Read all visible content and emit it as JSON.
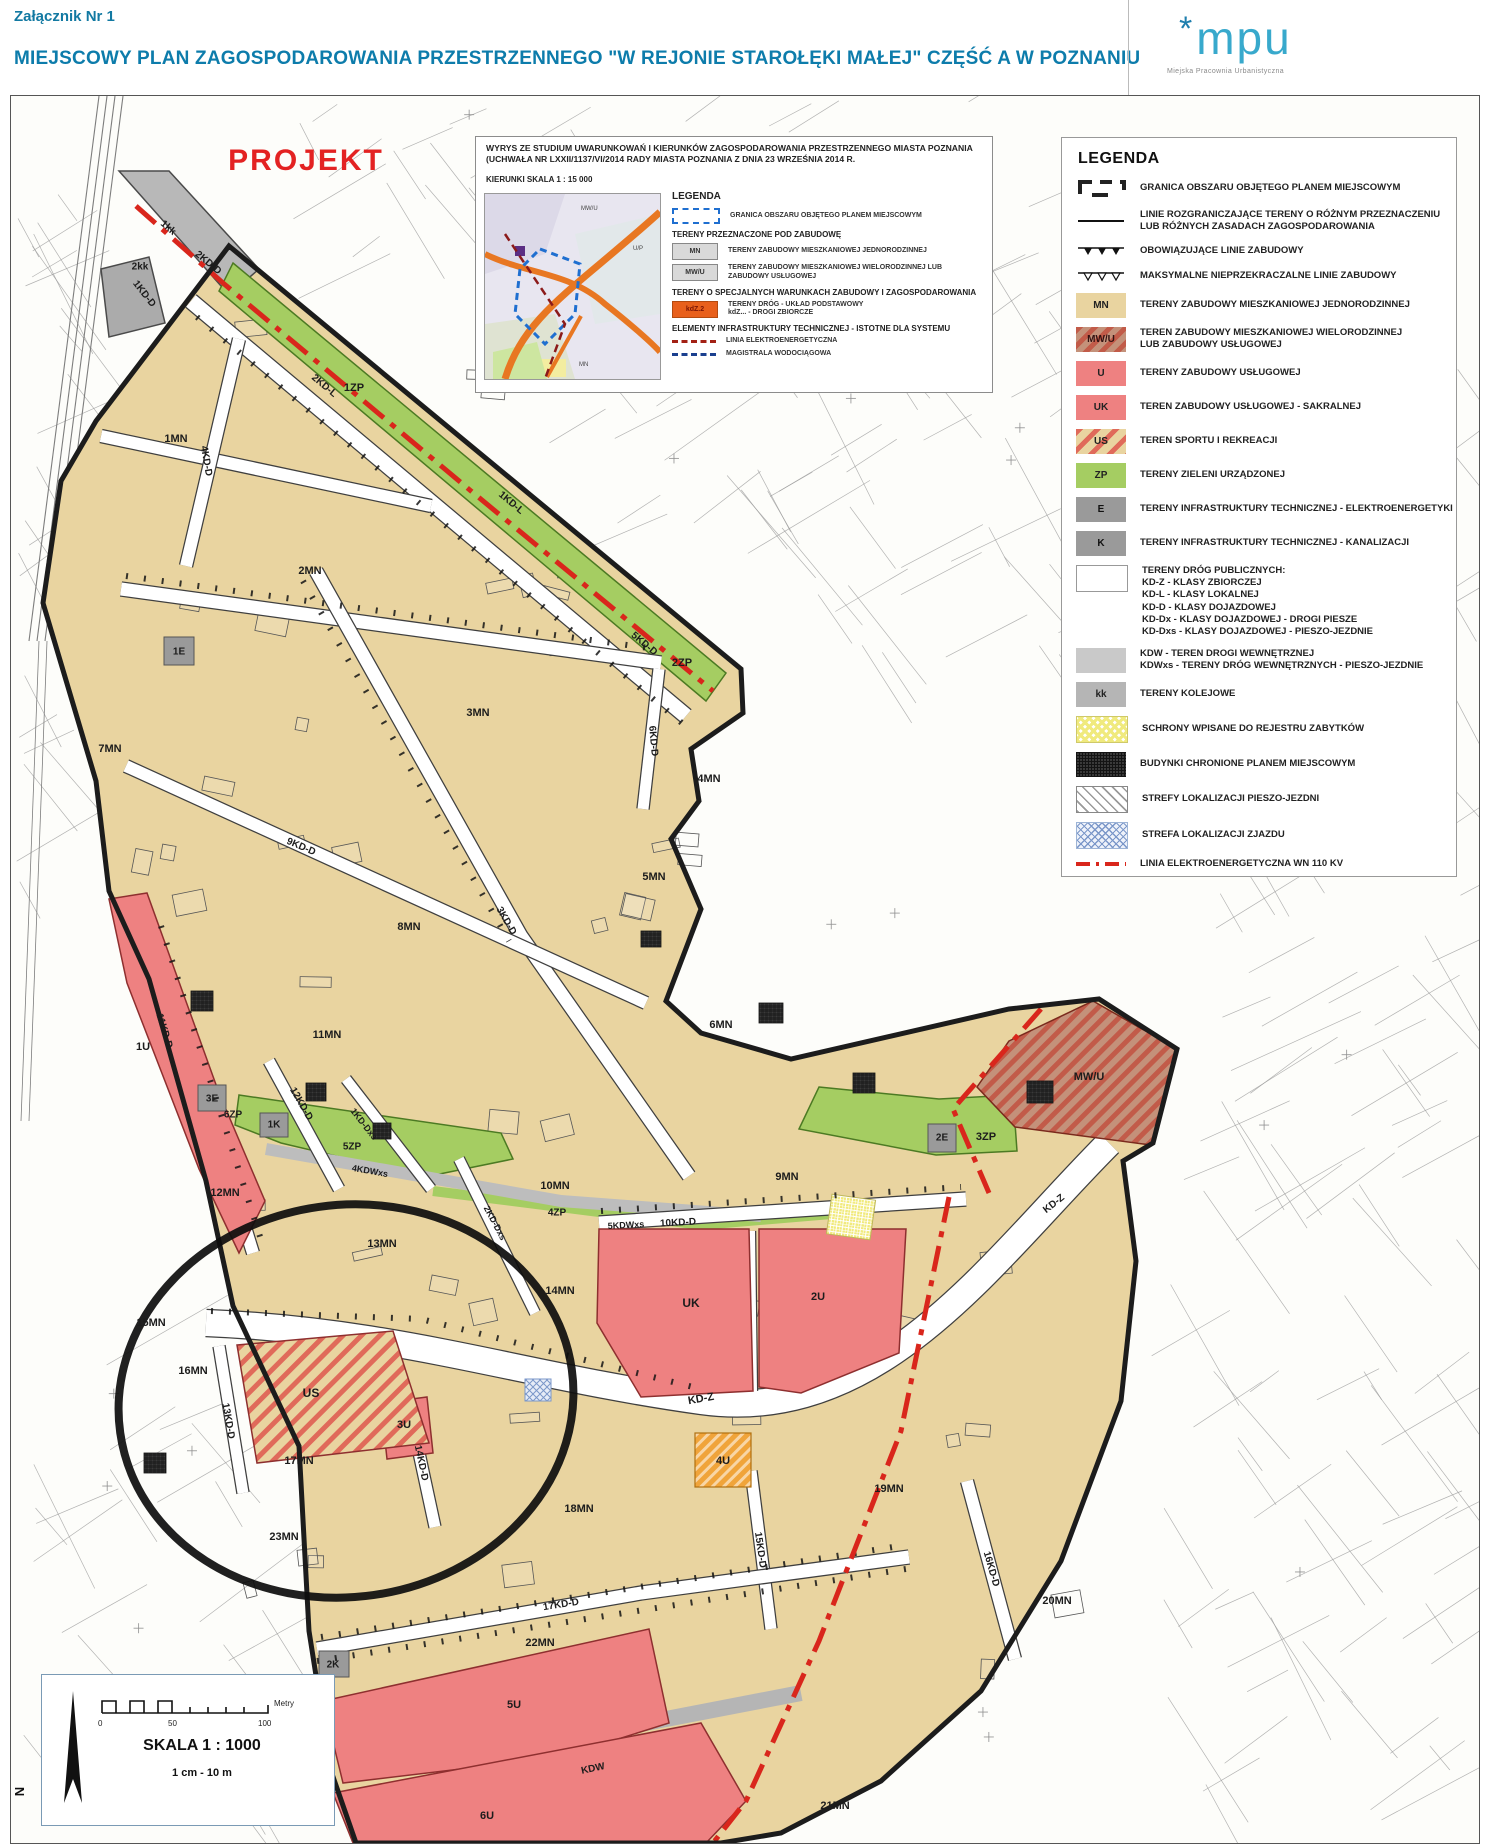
{
  "header": {
    "attachment": "Załącznik Nr 1",
    "title": "MIEJSCOWY PLAN ZAGOSPODAROWANIA PRZESTRZENNEGO \"W REJONIE STAROŁĘKI MAŁEJ\" CZĘŚĆ A W POZNANIU",
    "logo_star": "*",
    "logo_mark": "mpu",
    "logo_subtitle": "Miejska Pracownia Urbanistyczna"
  },
  "inset": {
    "title_line1": "WYRYS ZE STUDIUM UWARUNKOWAŃ I KIERUNKÓW ZAGOSPODAROWANIA PRZESTRZENNEGO MIASTA POZNANIA",
    "title_line2": "(UCHWAŁA NR LXXII/1137/VI/2014 RADY MIASTA POZNANIA Z DNIA 23 WRZEŚNIA 2014 R.",
    "title_line3": "KIERUNKI SKALA 1 : 15 000",
    "legend_title": "LEGENDA",
    "items": {
      "granica": "GRANICA OBSZARU OBJĘTEGO PLANEM MIEJSCOWYM",
      "section_zabudowa": "TERENY PRZEZNACZONE POD ZABUDOWĘ",
      "mn_code": "MN",
      "mn": "TERENY ZABUDOWY MIESZKANIOWEJ JEDNORODZINNEJ",
      "mwu_code": "MW/U",
      "mwu": "TERENY ZABUDOWY MIESZKANIOWEJ WIELORODZINNEJ LUB ZABUDOWY USŁUGOWEJ",
      "section_spec": "TERENY O SPECJALNYCH WARUNKACH ZABUDOWY I ZAGOSPODAROWANIA",
      "kdz_code": "kdZ.2",
      "kdz": "TERENY DRÓG - UKŁAD PODSTAWOWY\nkdZ... - DROGI ZBIORCZE",
      "section_infra": "ELEMENTY INFRASTRUKTURY TECHNICZNEJ - ISTOTNE DLA SYSTEMU",
      "linia": "LINIA ELEKTROENERGETYCZNA",
      "magistrala": "MAGISTRALA WODOCIĄGOWA"
    },
    "map_labels": [
      {
        "t": "MW/U"
      },
      {
        "t": "U/P"
      },
      {
        "t": "MN"
      }
    ]
  },
  "legend": {
    "title": "LEGENDA",
    "items": [
      {
        "label": "GRANICA OBSZARU OBJĘTEGO PLANEM MIEJSCOWYM"
      },
      {
        "label": "LINIE ROZGRANICZAJĄCE TERENY O RÓŻNYM PRZEZNACZENIU\nLUB RÓŻNYCH ZASADACH ZAGOSPODAROWANIA"
      },
      {
        "label": "OBOWIĄZUJĄCE LINIE ZABUDOWY"
      },
      {
        "label": "MAKSYMALNE NIEPRZEKRACZALNE LINIE ZABUDOWY"
      },
      {
        "code": "MN",
        "label": "TERENY ZABUDOWY MIESZKANIOWEJ JEDNORODZINNEJ"
      },
      {
        "code": "MW/U",
        "label": "TEREN ZABUDOWY MIESZKANIOWEJ WIELORODZINNEJ\nLUB ZABUDOWY USŁUGOWEJ"
      },
      {
        "code": "U",
        "label": "TERENY ZABUDOWY USŁUGOWEJ"
      },
      {
        "code": "UK",
        "label": "TEREN ZABUDOWY USŁUGOWEJ - SAKRALNEJ"
      },
      {
        "code": "US",
        "label": "TEREN SPORTU I REKREACJI"
      },
      {
        "code": "ZP",
        "label": "TERENY ZIELENI URZĄDZONEJ"
      },
      {
        "code": "E",
        "label": "TERENY INFRASTRUKTURY TECHNICZNEJ - ELEKTROENERGETYKI"
      },
      {
        "code": "K",
        "label": "TERENY INFRASTRUKTURY TECHNICZNEJ - KANALIZACJI"
      },
      {
        "label": "TERENY DRÓG PUBLICZNYCH:\nKD-Z - KLASY ZBIORCZEJ\nKD-L - KLASY LOKALNEJ\nKD-D - KLASY DOJAZDOWEJ\nKD-Dx - KLASY DOJAZDOWEJ - DROGI PIESZE\nKD-Dxs - KLASY DOJAZDOWEJ - PIESZO-JEZDNIE"
      },
      {
        "label": "KDW - TEREN DROGI WEWNĘTRZNEJ\nKDWxs - TERENY DRÓG WEWNĘTRZNYCH - PIESZO-JEZDNIE"
      },
      {
        "code": "kk",
        "label": "TERENY KOLEJOWE"
      },
      {
        "label": "SCHRONY WPISANE DO REJESTRU ZABYTKÓW"
      },
      {
        "label": "BUDYNKI CHRONIONE PLANEM MIEJSCOWYM"
      },
      {
        "label": "STREFY LOKALIZACJI PIESZO-JEZDNI"
      },
      {
        "label": "STREFA LOKALIZACJI ZJAZDU"
      },
      {
        "label": "LINIA ELEKTROENERGETYCZNA WN 110 KV"
      }
    ]
  },
  "scale": {
    "skala": "SKALA 1 : 1000",
    "ratio": "1 cm - 10 m",
    "unit": "Metry",
    "t0": "0",
    "t50": "50",
    "t100": "100",
    "north": "N"
  },
  "map": {
    "labels": [
      {
        "t": "PROJEKT",
        "x": 305,
        "y": 160,
        "s": 30,
        "c": "#e32222",
        "ls": 2,
        "n": "projekt-stamp"
      },
      {
        "t": "1MN",
        "x": 175,
        "y": 438
      },
      {
        "t": "2MN",
        "x": 309,
        "y": 570
      },
      {
        "t": "3MN",
        "x": 477,
        "y": 712
      },
      {
        "t": "4MN",
        "x": 708,
        "y": 778
      },
      {
        "t": "5MN",
        "x": 653,
        "y": 876
      },
      {
        "t": "6MN",
        "x": 720,
        "y": 1024
      },
      {
        "t": "7MN",
        "x": 109,
        "y": 748
      },
      {
        "t": "8MN",
        "x": 408,
        "y": 926
      },
      {
        "t": "9MN",
        "x": 786,
        "y": 1176
      },
      {
        "t": "10MN",
        "x": 554,
        "y": 1185
      },
      {
        "t": "11MN",
        "x": 326,
        "y": 1034
      },
      {
        "t": "12MN",
        "x": 224,
        "y": 1192
      },
      {
        "t": "13MN",
        "x": 381,
        "y": 1243
      },
      {
        "t": "14MN",
        "x": 559,
        "y": 1290
      },
      {
        "t": "15MN",
        "x": 150,
        "y": 1322
      },
      {
        "t": "16MN",
        "x": 192,
        "y": 1370
      },
      {
        "t": "17MN",
        "x": 298,
        "y": 1460
      },
      {
        "t": "18MN",
        "x": 578,
        "y": 1508
      },
      {
        "t": "19MN",
        "x": 888,
        "y": 1488
      },
      {
        "t": "20MN",
        "x": 1056,
        "y": 1600
      },
      {
        "t": "21MN",
        "x": 834,
        "y": 1805
      },
      {
        "t": "22MN",
        "x": 539,
        "y": 1642
      },
      {
        "t": "23MN",
        "x": 283,
        "y": 1536
      },
      {
        "t": "1U",
        "x": 142,
        "y": 1046
      },
      {
        "t": "2U",
        "x": 817,
        "y": 1296
      },
      {
        "t": "3U",
        "x": 403,
        "y": 1424
      },
      {
        "t": "4U",
        "x": 722,
        "y": 1460
      },
      {
        "t": "5U",
        "x": 513,
        "y": 1704
      },
      {
        "t": "6U",
        "x": 486,
        "y": 1815
      },
      {
        "t": "UK",
        "x": 690,
        "y": 1302,
        "s": 12
      },
      {
        "t": "US",
        "x": 310,
        "y": 1392,
        "s": 12
      },
      {
        "t": "MW/U",
        "x": 1088,
        "y": 1076
      },
      {
        "t": "1ZP",
        "x": 353,
        "y": 387
      },
      {
        "t": "2ZP",
        "x": 681,
        "y": 662
      },
      {
        "t": "3ZP",
        "x": 985,
        "y": 1136
      },
      {
        "t": "4ZP",
        "x": 556,
        "y": 1212,
        "s": 10
      },
      {
        "t": "5ZP",
        "x": 351,
        "y": 1146,
        "s": 10
      },
      {
        "t": "6ZP",
        "x": 232,
        "y": 1114,
        "s": 10
      },
      {
        "t": "1E",
        "x": 178,
        "y": 651,
        "s": 10
      },
      {
        "t": "2E",
        "x": 941,
        "y": 1137,
        "s": 10
      },
      {
        "t": "3E",
        "x": 211,
        "y": 1098,
        "s": 10
      },
      {
        "t": "1K",
        "x": 273,
        "y": 1124,
        "s": 10
      },
      {
        "t": "2K",
        "x": 332,
        "y": 1664,
        "s": 10
      },
      {
        "t": "1kk",
        "x": 167,
        "y": 227,
        "r": 40,
        "s": 10
      },
      {
        "t": "2kk",
        "x": 139,
        "y": 266,
        "s": 10
      },
      {
        "t": "1KD-D",
        "x": 143,
        "y": 293,
        "r": 52,
        "s": 10
      },
      {
        "t": "2KD-D",
        "x": 207,
        "y": 262,
        "r": 40,
        "s": 10
      },
      {
        "t": "2KD-L",
        "x": 323,
        "y": 385,
        "r": 40,
        "s": 10
      },
      {
        "t": "1KD-L",
        "x": 510,
        "y": 502,
        "r": 40,
        "s": 10
      },
      {
        "t": "4KD-D",
        "x": 205,
        "y": 460,
        "r": 80,
        "s": 10
      },
      {
        "t": "3KD-D",
        "x": 505,
        "y": 920,
        "r": 60,
        "s": 10
      },
      {
        "t": "5KD-D",
        "x": 643,
        "y": 643,
        "r": 40,
        "s": 10
      },
      {
        "t": "6KD-D",
        "x": 652,
        "y": 740,
        "r": 85,
        "s": 10
      },
      {
        "t": "9KD-D",
        "x": 300,
        "y": 846,
        "r": 23,
        "s": 10
      },
      {
        "t": "10KD-D",
        "x": 677,
        "y": 1222,
        "r": -3,
        "s": 10
      },
      {
        "t": "11KD-D",
        "x": 163,
        "y": 1030,
        "r": 73,
        "s": 10
      },
      {
        "t": "12KD-D",
        "x": 300,
        "y": 1103,
        "r": 60,
        "s": 10
      },
      {
        "t": "13KD-D",
        "x": 227,
        "y": 1420,
        "r": 80,
        "s": 10
      },
      {
        "t": "14KD-D",
        "x": 420,
        "y": 1462,
        "r": 78,
        "s": 10
      },
      {
        "t": "15KD-D",
        "x": 759,
        "y": 1549,
        "r": 82,
        "s": 10
      },
      {
        "t": "16KD-D",
        "x": 990,
        "y": 1568,
        "r": 74,
        "s": 10
      },
      {
        "t": "17KD-D",
        "x": 560,
        "y": 1604,
        "r": -9,
        "s": 10
      },
      {
        "t": "KD-Z",
        "x": 700,
        "y": 1398,
        "r": -10,
        "s": 11
      },
      {
        "t": "KD-Z",
        "x": 1053,
        "y": 1203,
        "r": -38,
        "s": 10
      },
      {
        "t": "KDW",
        "x": 592,
        "y": 1768,
        "r": -12,
        "s": 10
      },
      {
        "t": "1KD-Dxs",
        "x": 363,
        "y": 1123,
        "r": 52,
        "s": 9
      },
      {
        "t": "2KD-Dxs",
        "x": 494,
        "y": 1222,
        "r": 62,
        "s": 9
      },
      {
        "t": "4KDWxs",
        "x": 369,
        "y": 1170,
        "r": 10,
        "s": 9
      },
      {
        "t": "5KDWxs",
        "x": 625,
        "y": 1224,
        "r": -3,
        "s": 9
      }
    ]
  }
}
